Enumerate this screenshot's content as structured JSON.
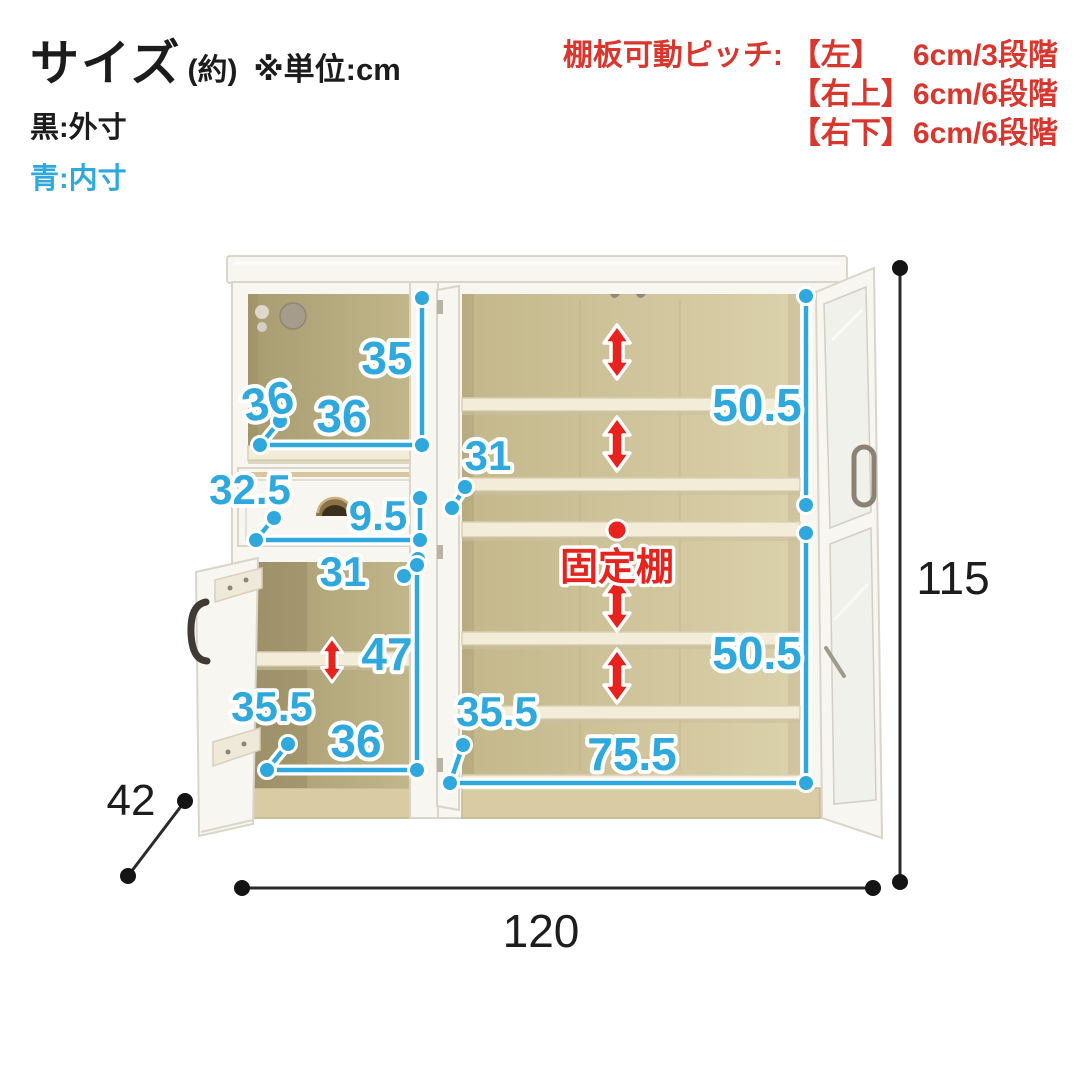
{
  "header": {
    "title": "サイズ",
    "title_note": "(約)",
    "unit_note": "※単位:cm",
    "legend": {
      "black": "黒:外寸",
      "blue": "青:内寸"
    },
    "pitch": {
      "prefix": "棚板可動ピッチ:",
      "rows": [
        {
          "bracket": "【左】",
          "value": "6cm/3段階"
        },
        {
          "bracket": "【右上】",
          "value": "6cm/6段階"
        },
        {
          "bracket": "【右下】",
          "value": "6cm/6段階"
        }
      ]
    }
  },
  "diagram": {
    "unit": "cm",
    "outer": {
      "width": "120",
      "height": "115",
      "depth": "42"
    },
    "left_top": {
      "height": "35",
      "width": "36",
      "depth": "36"
    },
    "drawer": {
      "depth": "32.5",
      "height": "9.5"
    },
    "left_lower": {
      "depth_label": "31",
      "height": "47",
      "front_depth": "35.5",
      "width": "36"
    },
    "right": {
      "depth_label": "31",
      "upper_height": "50.5",
      "lower_height": "50.5",
      "front_depth": "35.5",
      "width": "75.5"
    },
    "fixed_shelf": "固定棚"
  },
  "colors": {
    "blue": "#2fa9dd",
    "red": "#e8231d",
    "header_red": "#d9362e",
    "black": "#1d1d1d"
  }
}
